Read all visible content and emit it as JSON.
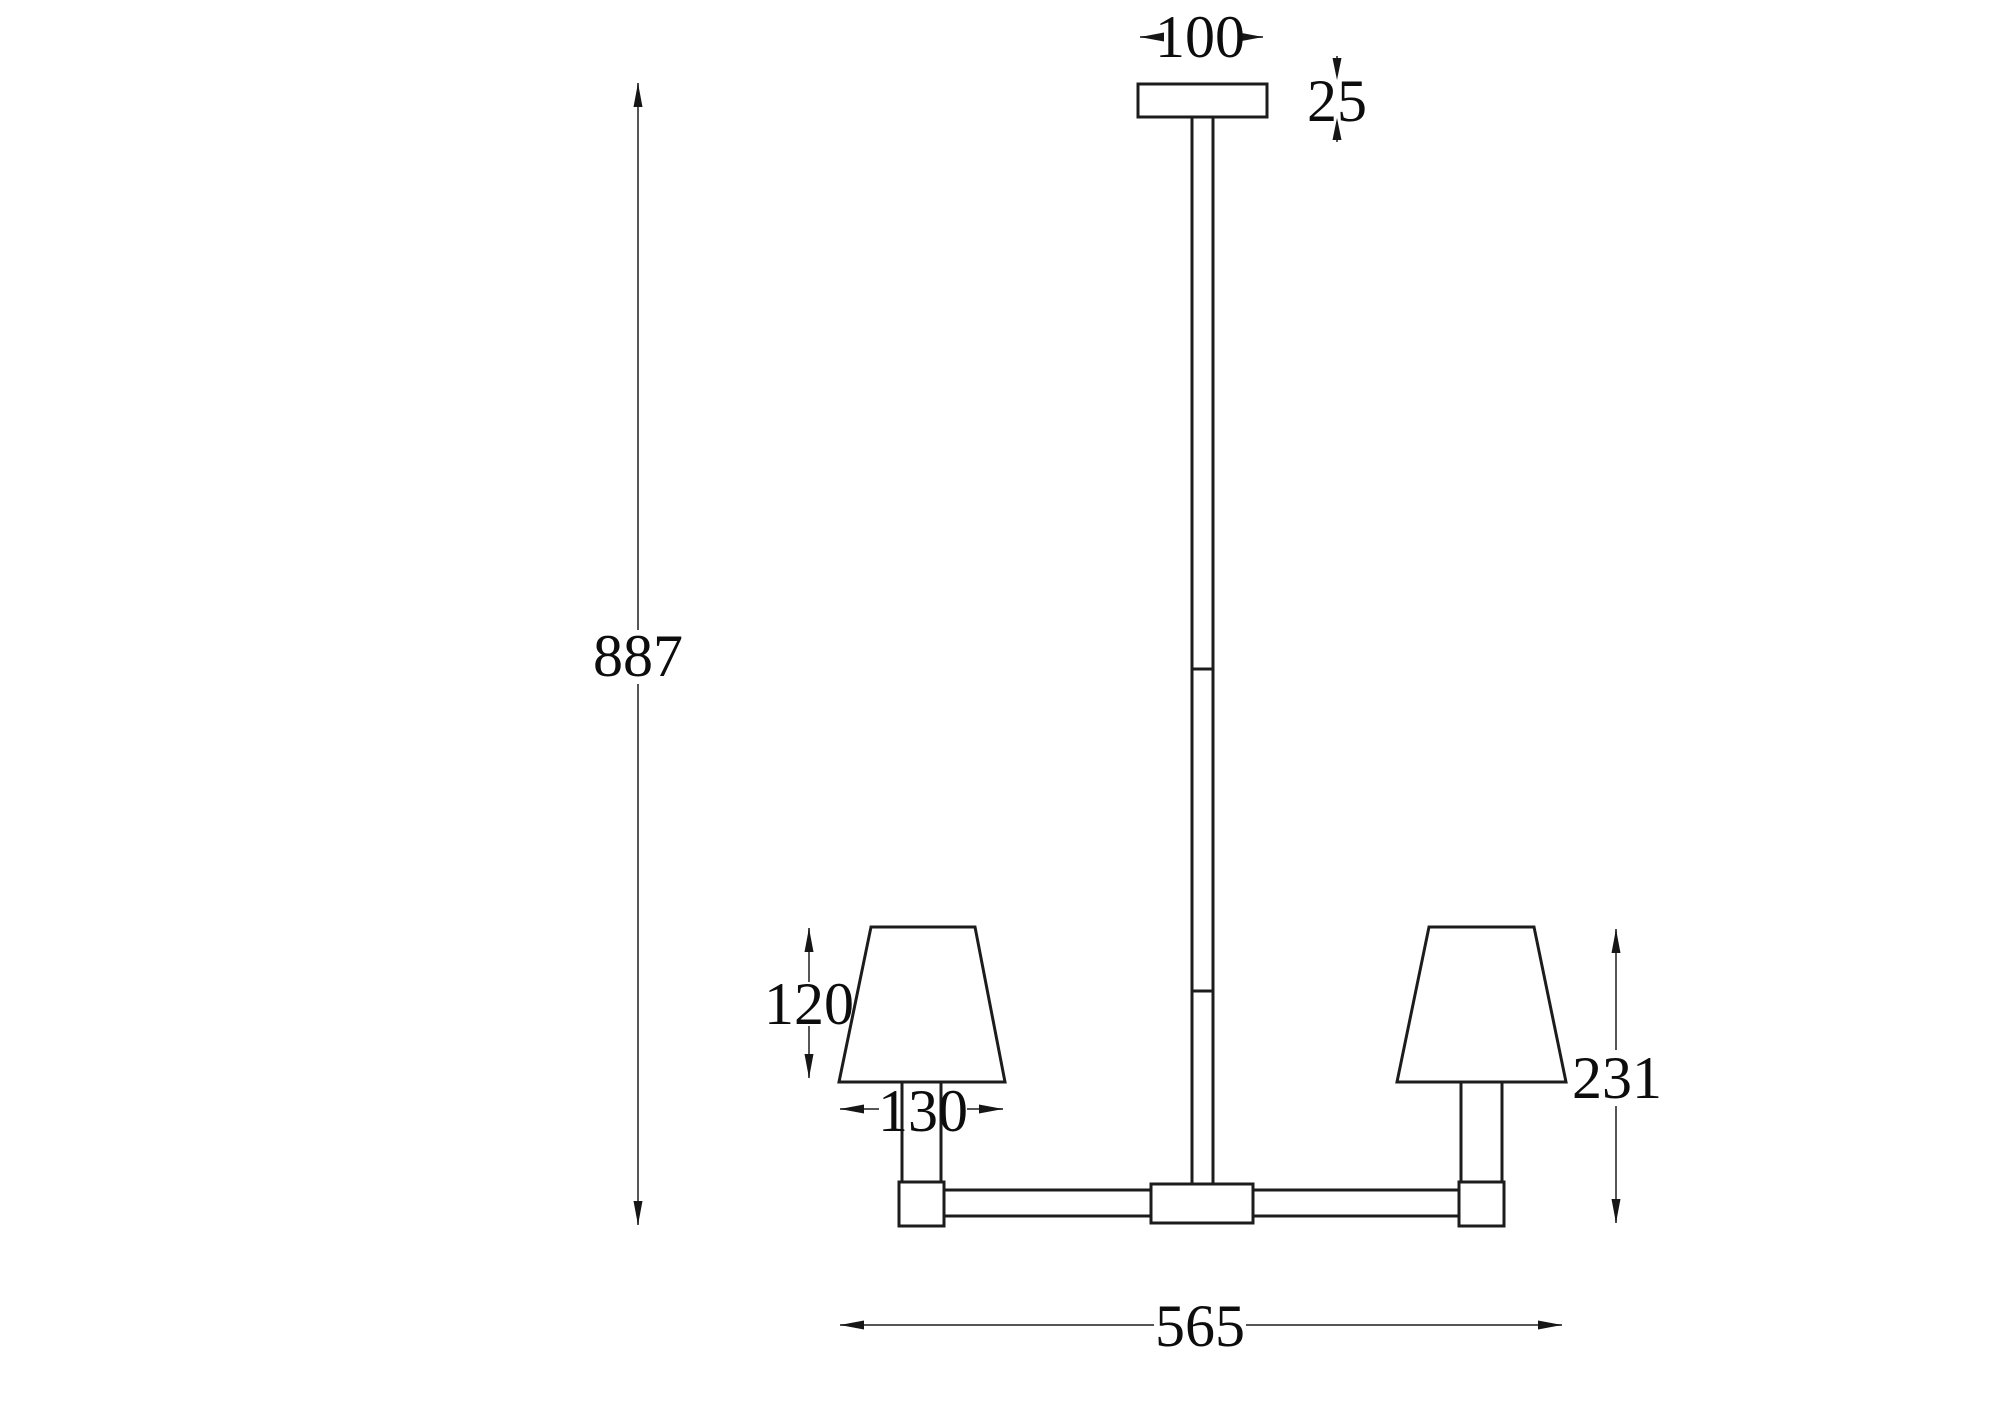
{
  "drawing": {
    "type": "technical-dimension-drawing",
    "subject": "two-arm pendant lamp elevation",
    "background_color": "#ffffff",
    "fixture_line_color": "#1c1c1c",
    "dimension_line_color": "#565656",
    "text_color": "#0d0d0d"
  },
  "dims": {
    "canopy_width": "100",
    "canopy_height": "25",
    "overall_height": "887",
    "shade_height": "120",
    "shade_diameter": "130",
    "lamp_section_height": "231",
    "overall_width": "565"
  }
}
